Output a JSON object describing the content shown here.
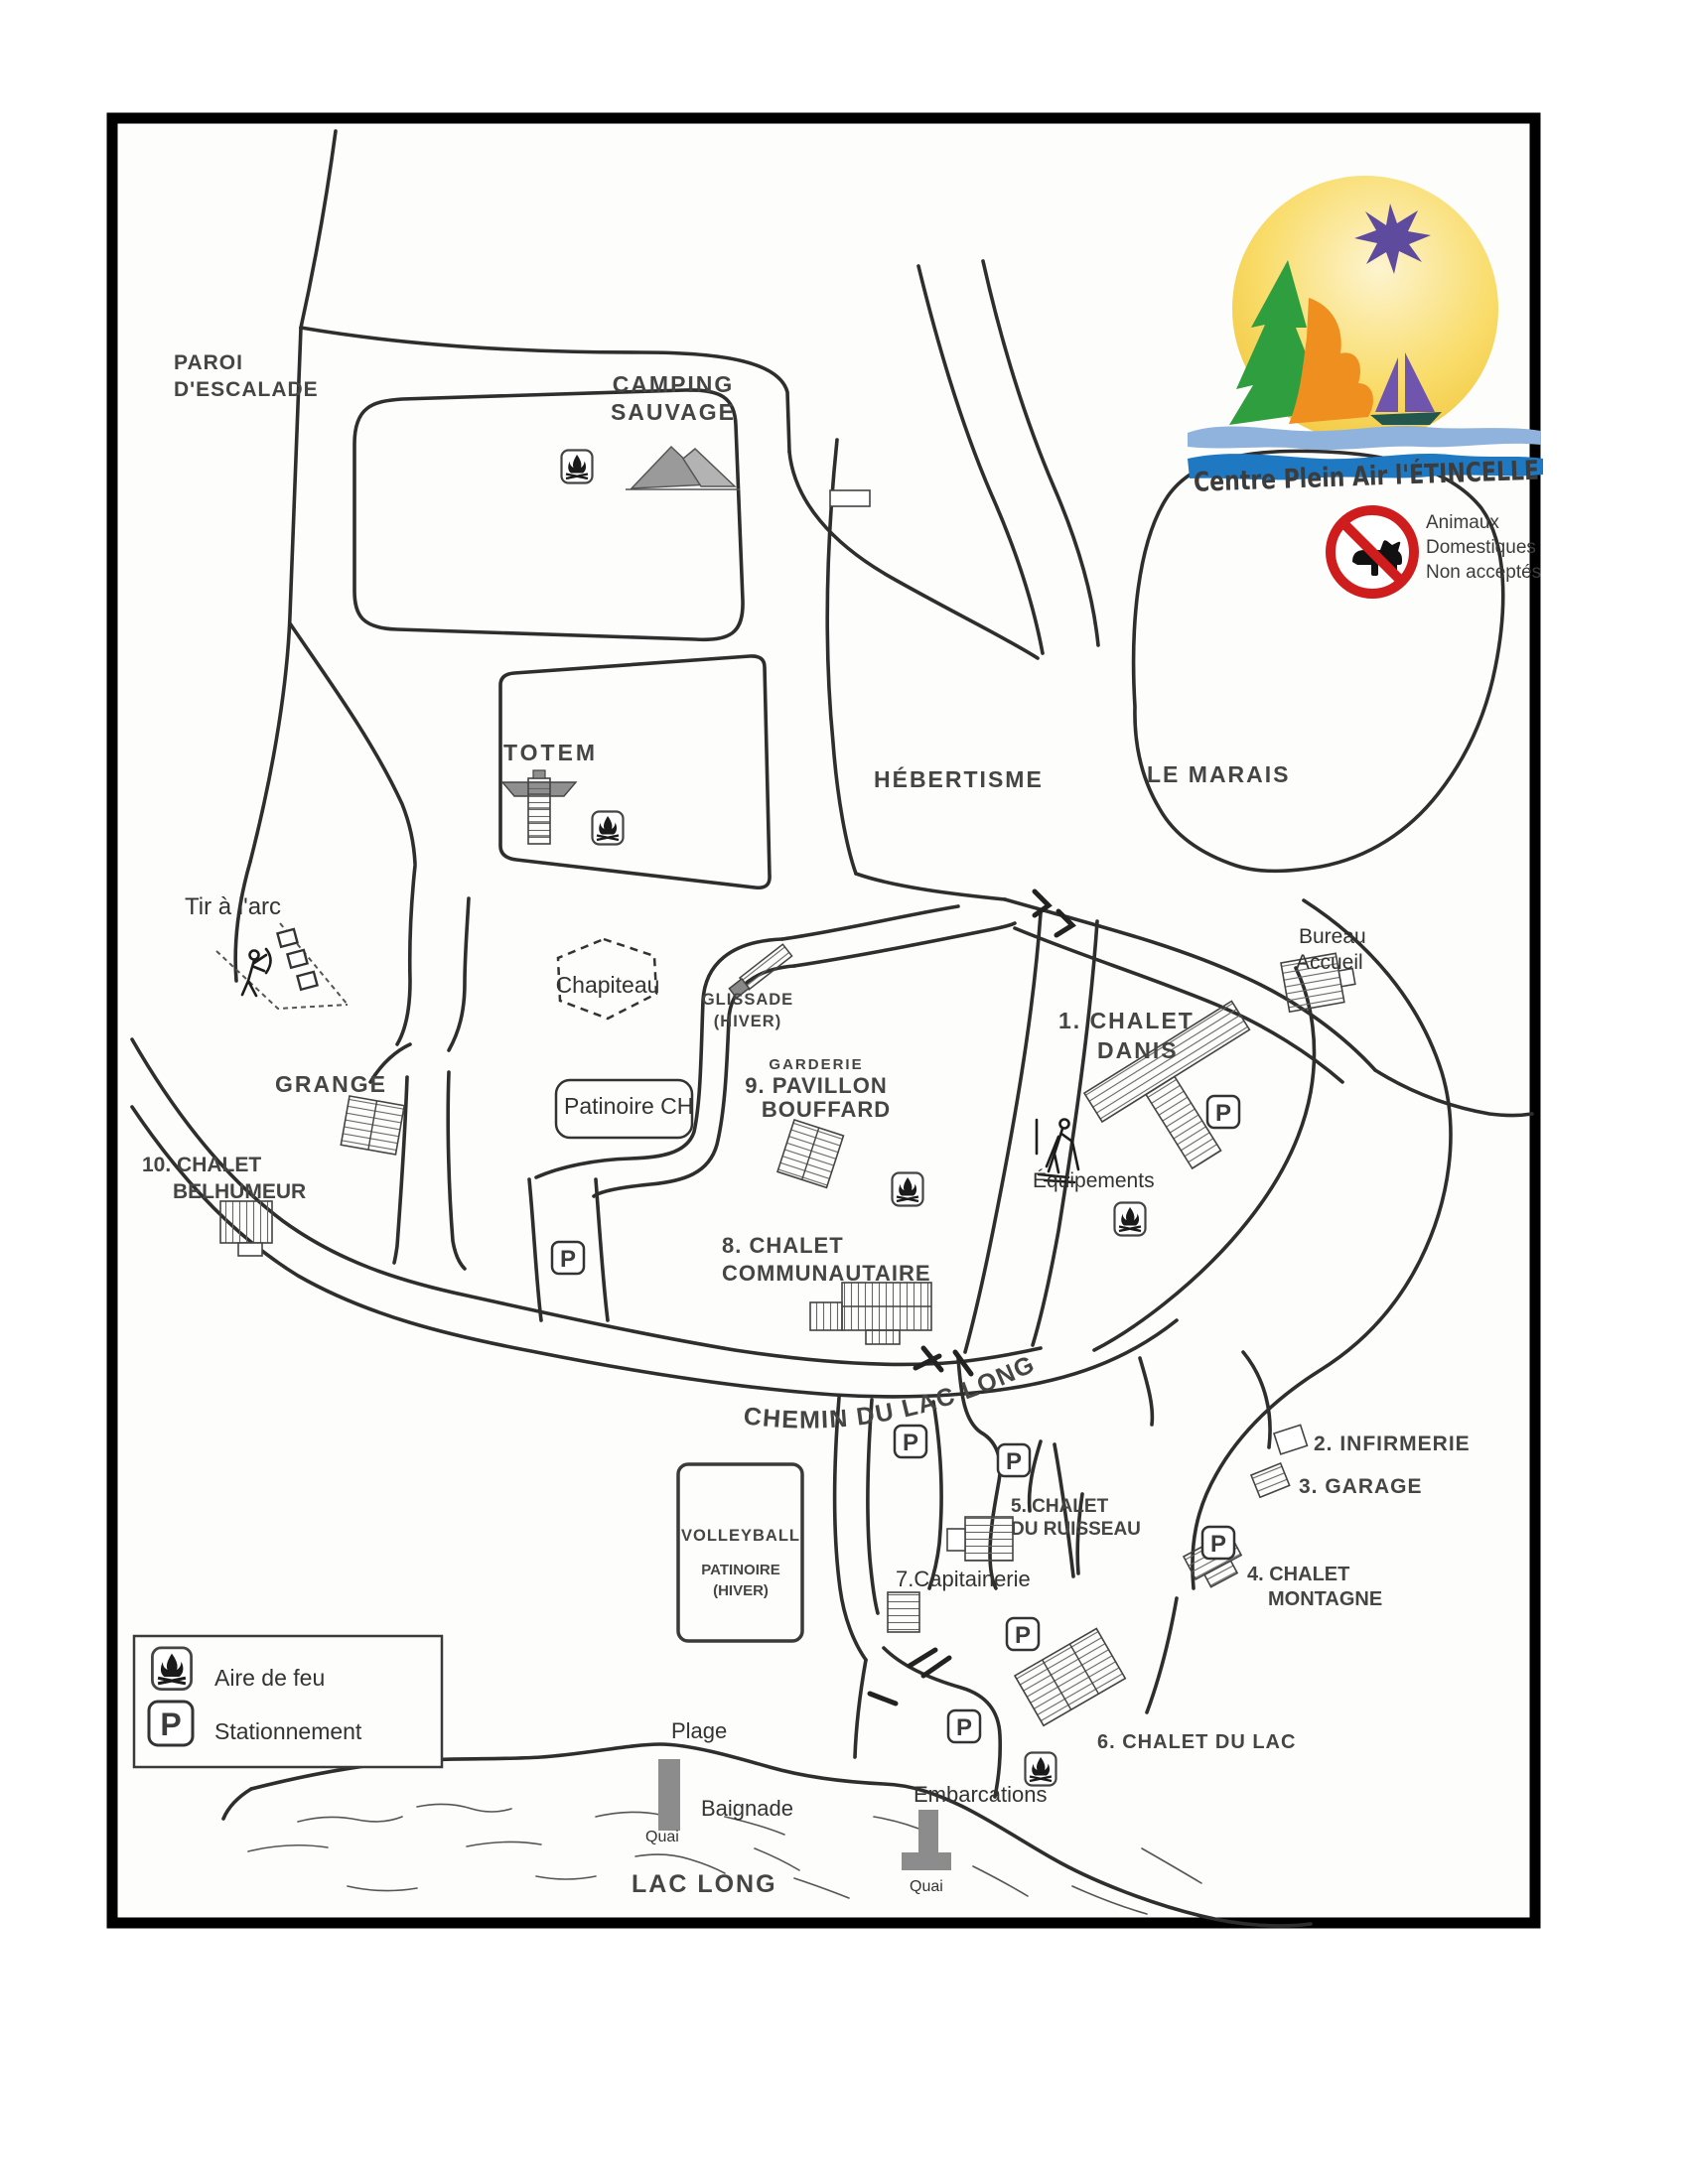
{
  "logo": {
    "text": "Centre Plein Air l'ÉTINCELLE",
    "colors": {
      "sun": "#f2c737",
      "star": "#5f4b9e",
      "tree": "#2f9e3f",
      "flame": "#ef8f1f",
      "sail": "#6f55ae",
      "hull": "#23574d",
      "wave_light": "#8fb3dd",
      "wave_dark": "#1e79c2"
    }
  },
  "no_pets": {
    "lines": [
      "Animaux",
      "Domestiques",
      "Non acceptés"
    ],
    "color": "#cf1d1d"
  },
  "legend": {
    "items": [
      {
        "icon": "campfire-icon",
        "label": "Aire de feu"
      },
      {
        "icon": "parking-icon",
        "label": "Stationnement"
      }
    ]
  },
  "icons": {
    "parking_letter": "P"
  },
  "colors": {
    "road": "#2e2e2e",
    "quai": "#8c8c8c",
    "building_stroke": "#444444",
    "text": "#3c3c3c"
  },
  "labels": {
    "paroi": {
      "lines": [
        "PAROI",
        "D'ESCALADE"
      ]
    },
    "camping": {
      "lines": [
        "CAMPING",
        "SAUVAGE"
      ]
    },
    "totem": {
      "text": "TOTEM"
    },
    "hebertisme": {
      "text": "HÉBERTISME"
    },
    "marais": {
      "text": "LE MARAIS"
    },
    "tir_arc": {
      "text": "Tir à l'arc"
    },
    "chapiteau": {
      "text": "Chapiteau"
    },
    "glissade": {
      "lines": [
        "GLISSADE",
        "(HIVER)"
      ]
    },
    "pavillon": {
      "lines": [
        "GARDERIE",
        "9. PAVILLON",
        "BOUFFARD"
      ]
    },
    "patinoire_ch": {
      "text": "Patinoire CH"
    },
    "grange": {
      "text": "GRANGE"
    },
    "belhumeur": {
      "lines": [
        "10. CHALET",
        "BELHUMEUR"
      ]
    },
    "communautaire": {
      "lines": [
        "8. CHALET",
        "COMMUNAUTAIRE"
      ]
    },
    "danis": {
      "lines": [
        "1. CHALET",
        "DANIS"
      ]
    },
    "bureau": {
      "lines": [
        "Bureau",
        "Accueil"
      ]
    },
    "equipements": {
      "text": "Équipements"
    },
    "chemin": {
      "text": "CHEMIN DU LAC LONG"
    },
    "infirmerie": {
      "text": "2. INFIRMERIE"
    },
    "garage": {
      "text": "3. GARAGE"
    },
    "ruisseau": {
      "lines": [
        "5. CHALET",
        "DU RUISSEAU"
      ]
    },
    "capitainerie": {
      "text": "7.Capitainerie"
    },
    "montagne": {
      "lines": [
        "4. CHALET",
        "MONTAGNE"
      ]
    },
    "chalet_lac": {
      "text": "6. CHALET DU LAC"
    },
    "volleyball": {
      "text": "VOLLEYBALL"
    },
    "patinoire_hiver": {
      "lines": [
        "PATINOIRE",
        "(HIVER)"
      ]
    },
    "plage": {
      "text": "Plage"
    },
    "baignade": {
      "text": "Baignade"
    },
    "quai_plage": {
      "text": "Quai"
    },
    "quai_embarcations": {
      "text": "Quai"
    },
    "lac_long": {
      "text": "LAC LONG"
    },
    "embarcations": {
      "text": "Embarcations"
    }
  }
}
